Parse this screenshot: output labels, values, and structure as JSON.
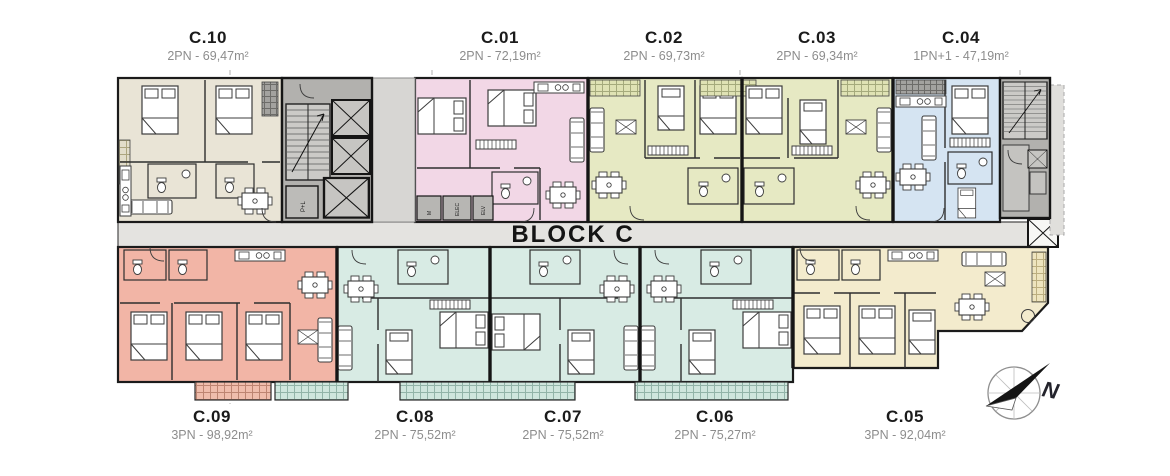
{
  "block": {
    "title": "BLOCK C"
  },
  "compass": {
    "label": "N"
  },
  "core": {
    "pl": "P+L",
    "m": "M",
    "elec": "ELEC",
    "elv": "ELV"
  },
  "units": [
    {
      "label": "C.10",
      "bedrooms": "2PN",
      "area": "69,47m²",
      "spec": "2PN - 69,47m²",
      "color": "#e9e4d6"
    },
    {
      "label": "C.01",
      "bedrooms": "2PN",
      "area": "72,19m²",
      "spec": "2PN - 72,19m²",
      "color": "#f2d7e6"
    },
    {
      "label": "C.02",
      "bedrooms": "2PN",
      "area": "69,73m²",
      "spec": "2PN - 69,73m²",
      "color": "#e6e9c3"
    },
    {
      "label": "C.03",
      "bedrooms": "2PN",
      "area": "69,34m²",
      "spec": "2PN - 69,34m²",
      "color": "#e6e9c3"
    },
    {
      "label": "C.04",
      "bedrooms": "1PN+1",
      "area": "47,19m²",
      "spec": "1PN+1 - 47,19m²",
      "color": "#d5e4f2"
    },
    {
      "label": "C.09",
      "bedrooms": "3PN",
      "area": "98,92m²",
      "spec": "3PN - 98,92m²",
      "color": "#f2b5a6"
    },
    {
      "label": "C.08",
      "bedrooms": "2PN",
      "area": "75,52m²",
      "spec": "2PN - 75,52m²",
      "color": "#d8ebe4"
    },
    {
      "label": "C.07",
      "bedrooms": "2PN",
      "area": "75,52m²",
      "spec": "2PN - 75,52m²",
      "color": "#d8ebe4"
    },
    {
      "label": "C.06",
      "bedrooms": "2PN",
      "area": "75,27m²",
      "spec": "2PN - 75,27m²",
      "color": "#d8ebe4"
    },
    {
      "label": "C.05",
      "bedrooms": "3PN",
      "area": "92,04m²",
      "spec": "3PN - 92,04m²",
      "color": "#f3ebcd"
    }
  ],
  "colors": {
    "wall": "#1b1b1b",
    "core_gray": "#b2b1ae",
    "corridor_gray": "#e4e3e0"
  }
}
